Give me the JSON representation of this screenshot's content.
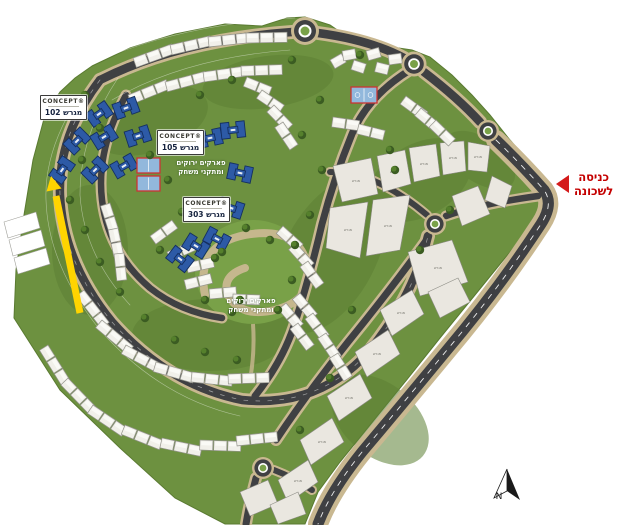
{
  "map": {
    "title": "neighborhood-site-plan",
    "plot_labels": [
      {
        "logo": "CONCEPT®",
        "name": "מגרש 102"
      },
      {
        "logo": "CONCEPT®",
        "name": "מגרש 105"
      },
      {
        "logo": "CONCEPT®",
        "name": "מגרש 303"
      }
    ],
    "park_labels": [
      {
        "line1": "פארקים ירוקים",
        "line2": "ומתקני משחק"
      },
      {
        "line1": "פארקים ירוקים",
        "line2": "ומתקני משחק"
      }
    ],
    "entrance": {
      "line1": "כניסה",
      "line2": "לשכונה"
    },
    "compass": {
      "label": "N"
    },
    "parcel_label": "מגרש",
    "colors": {
      "grass": "#6d9140",
      "grass_dark": "#5d8034",
      "park": "#79a148",
      "road": "#3f4043",
      "sidewalk": "#c9b891",
      "house": "#f1f0ea",
      "parcel": "#eae7e0",
      "highlight_building": "#2d5aa6",
      "court": "#92b8dc",
      "court_border": "#cc3333",
      "promo_arrow": "#ffd400",
      "entrance_red": "#c40000"
    }
  }
}
